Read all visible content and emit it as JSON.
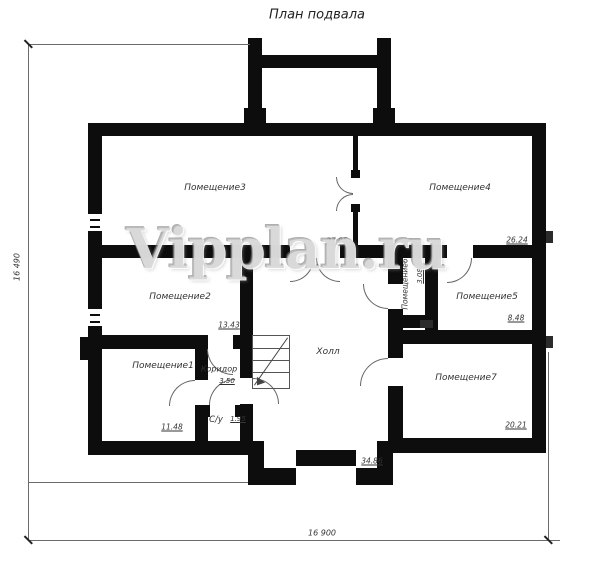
{
  "title": "План подвала",
  "watermark": "Vipplan.ru",
  "dimensions": {
    "height_total": "16 490",
    "width_total": "16 900"
  },
  "rooms": {
    "room1": {
      "label": "Помещение1",
      "area": "11.48"
    },
    "room2": {
      "label": "Помещение2",
      "area": "13.43"
    },
    "room3": {
      "label": "Помещение3",
      "area": "37.05"
    },
    "room4": {
      "label": "Помещение4",
      "area": "26.24"
    },
    "room5": {
      "label": "Помещение5",
      "area": "8.48"
    },
    "room6": {
      "label": "Помещение6",
      "area": "3.08"
    },
    "room7": {
      "label": "Помещение7",
      "area": "20.21"
    },
    "hall": {
      "label": "Холл",
      "area": "34.86"
    },
    "corridor": {
      "label": "Коридор",
      "area": "3.50"
    },
    "wc": {
      "label": "С/у",
      "area": "1.95"
    }
  },
  "colors": {
    "wall": "#0d0d0d",
    "dimension_line": "#6b6b6b",
    "label_text": "#333333",
    "watermark_gray": "#c6c6c6"
  }
}
